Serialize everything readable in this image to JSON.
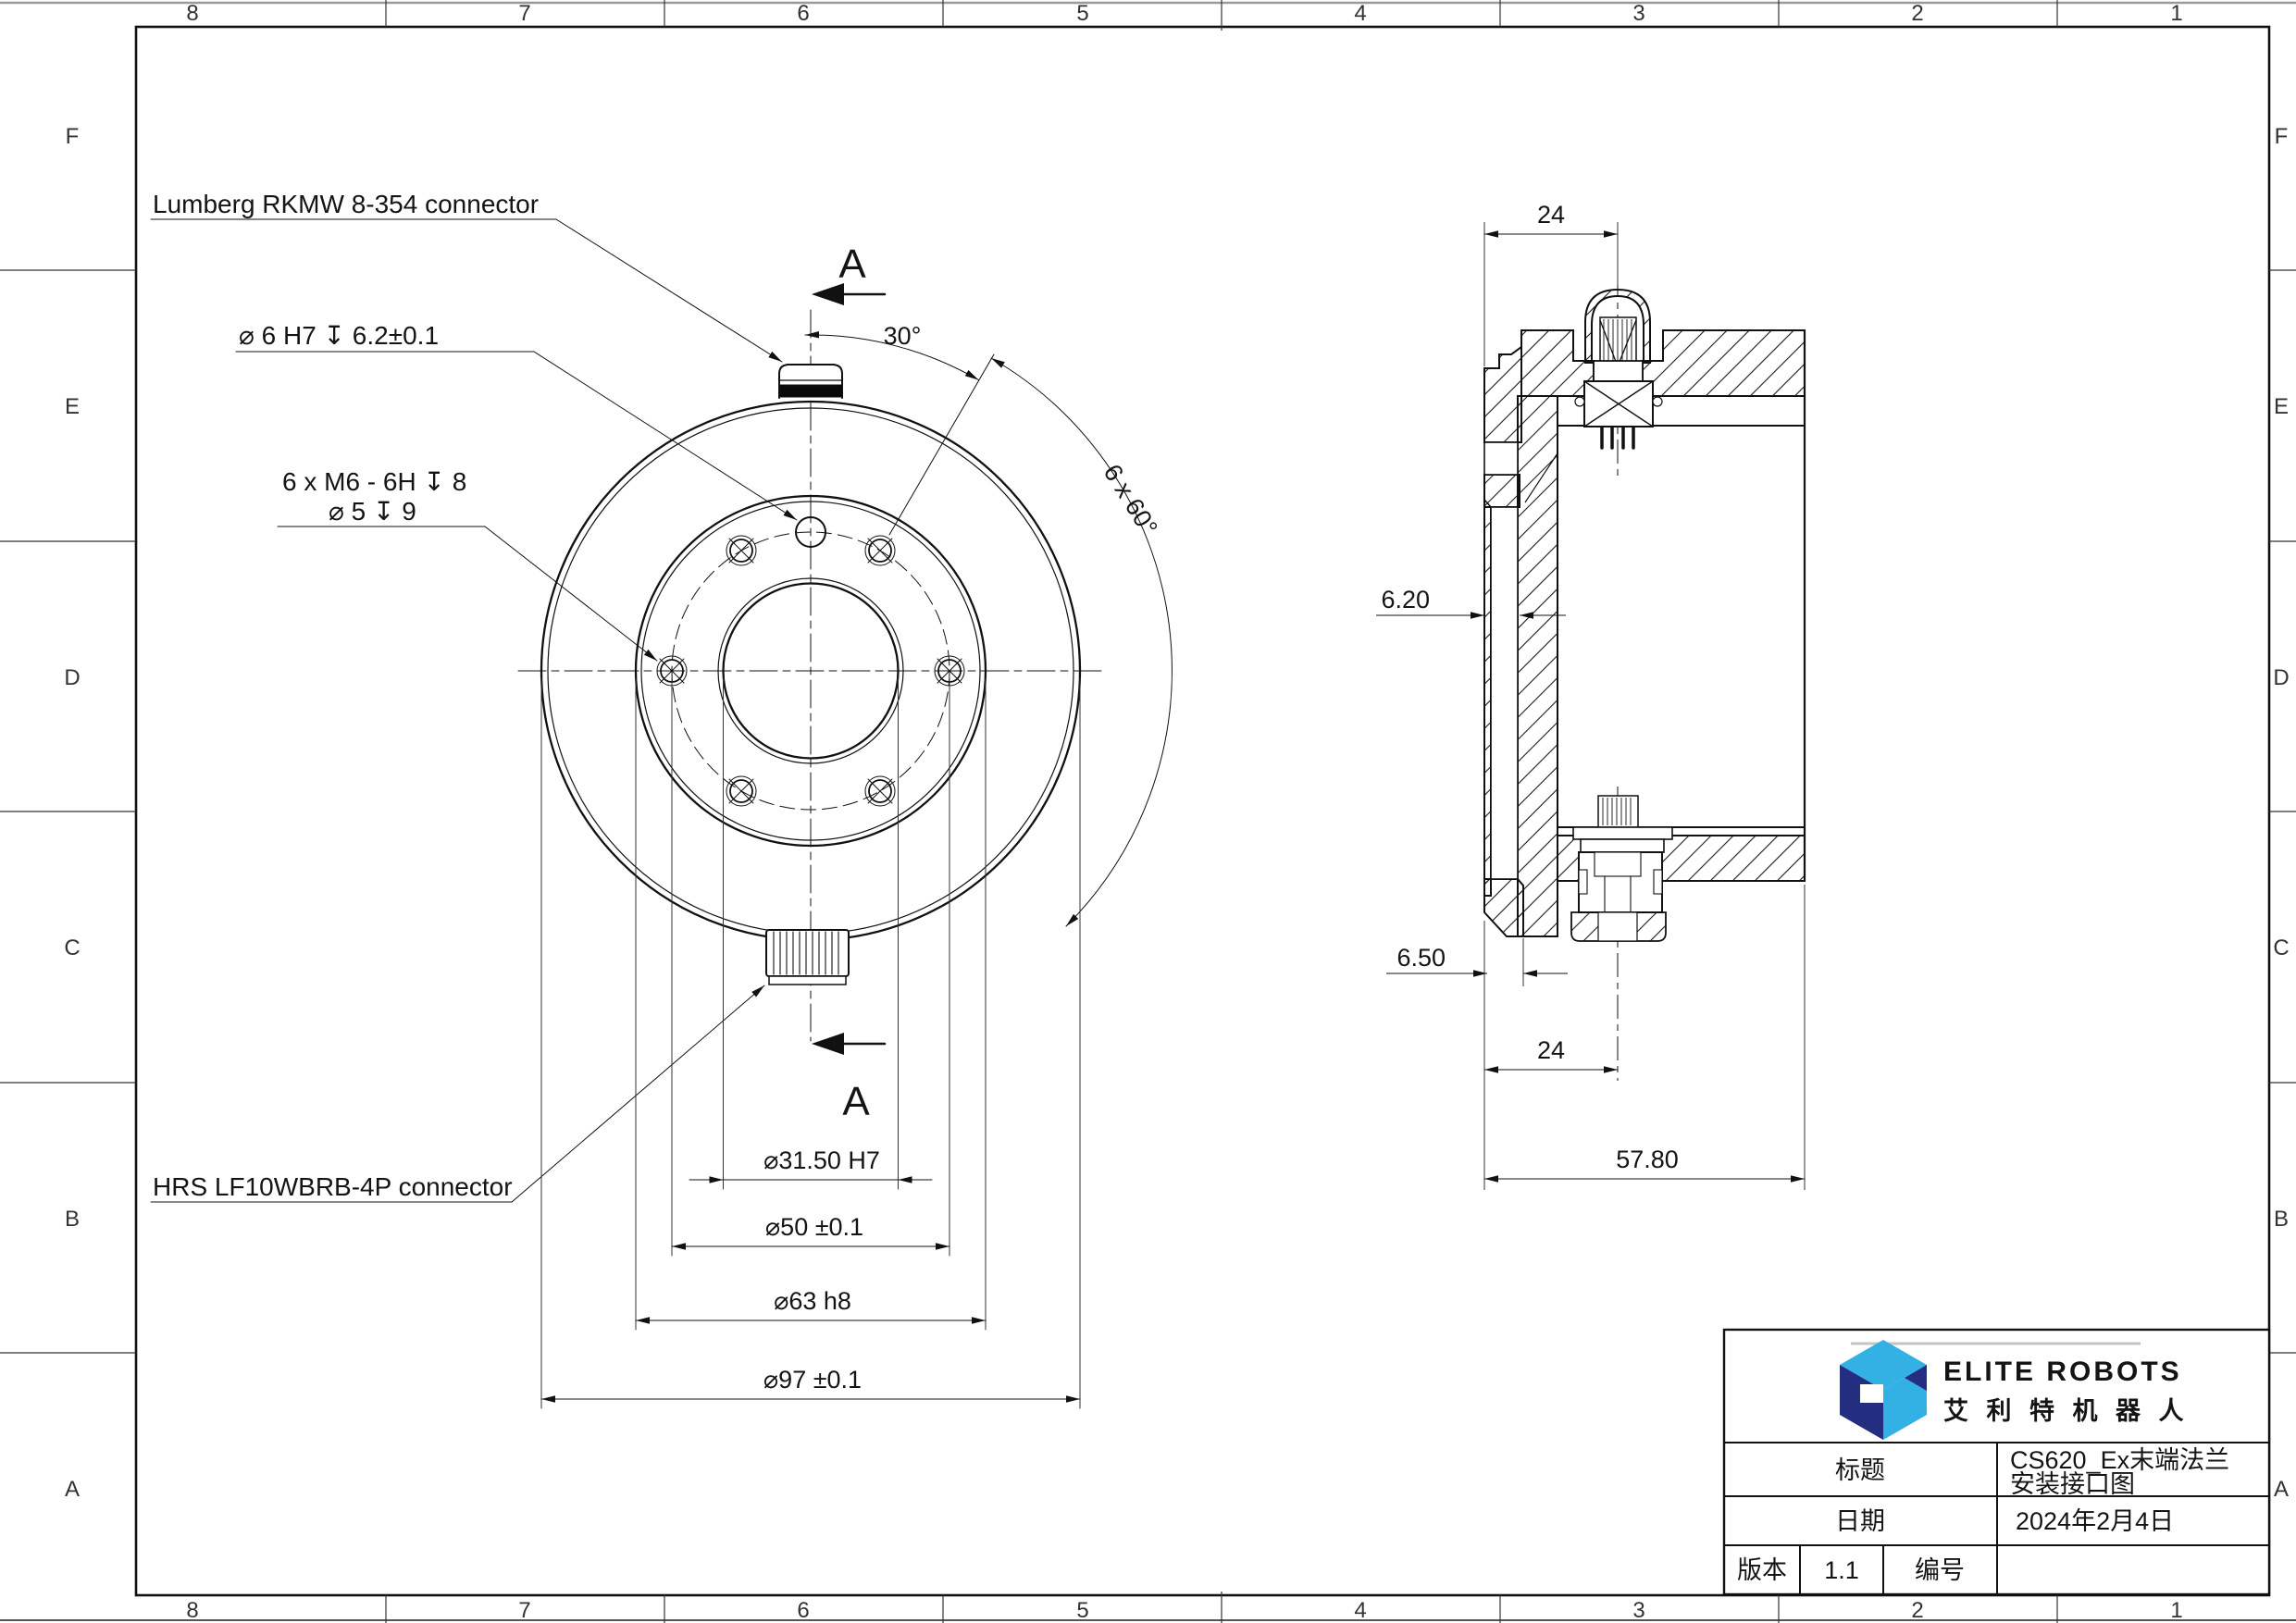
{
  "sheet": {
    "grid_cols": [
      "8",
      "7",
      "6",
      "5",
      "4",
      "3",
      "2",
      "1"
    ],
    "grid_rows": [
      "F",
      "E",
      "D",
      "C",
      "B",
      "A"
    ]
  },
  "front_view": {
    "labels": {
      "lumberg": "Lumberg RKMW 8-354 connector",
      "dowel": "⌀ 6 H7 ↧ 6.2±0.1",
      "tapped_line1": "6 x  M6 - 6H ↧ 8",
      "tapped_line2": "⌀ 5 ↧ 9",
      "hrs": "HRS LF10WBRB-4P  connector",
      "angle30": "30°",
      "angle6x60": "6 x 60°",
      "section_a": "A"
    },
    "dims": {
      "bore": "⌀31.50 H7",
      "bolt_circle": "⌀50 ±0.1",
      "boss": "⌀63 h8",
      "outer": "⌀97 ±0.1"
    }
  },
  "section_view": {
    "dims": {
      "top24": "24",
      "boss_height": "6.20",
      "step": "6.50",
      "bottom24": "24",
      "width": "57.80"
    }
  },
  "title_block": {
    "brand_en": "ELITE ROBOTS",
    "brand_cn": "艾 利 特 机 器 人",
    "title_label": "标题",
    "title_value_line1": "CS620_Ex末端法兰",
    "title_value_line2": "安装接口图",
    "date_label": "日期",
    "date_value": "2024年2月4日",
    "version_label": "版本",
    "version_value": "1.1",
    "number_label": "编号",
    "number_value": "",
    "colors": {
      "navy": "#232e80",
      "light_blue": "#33b1e4"
    }
  }
}
